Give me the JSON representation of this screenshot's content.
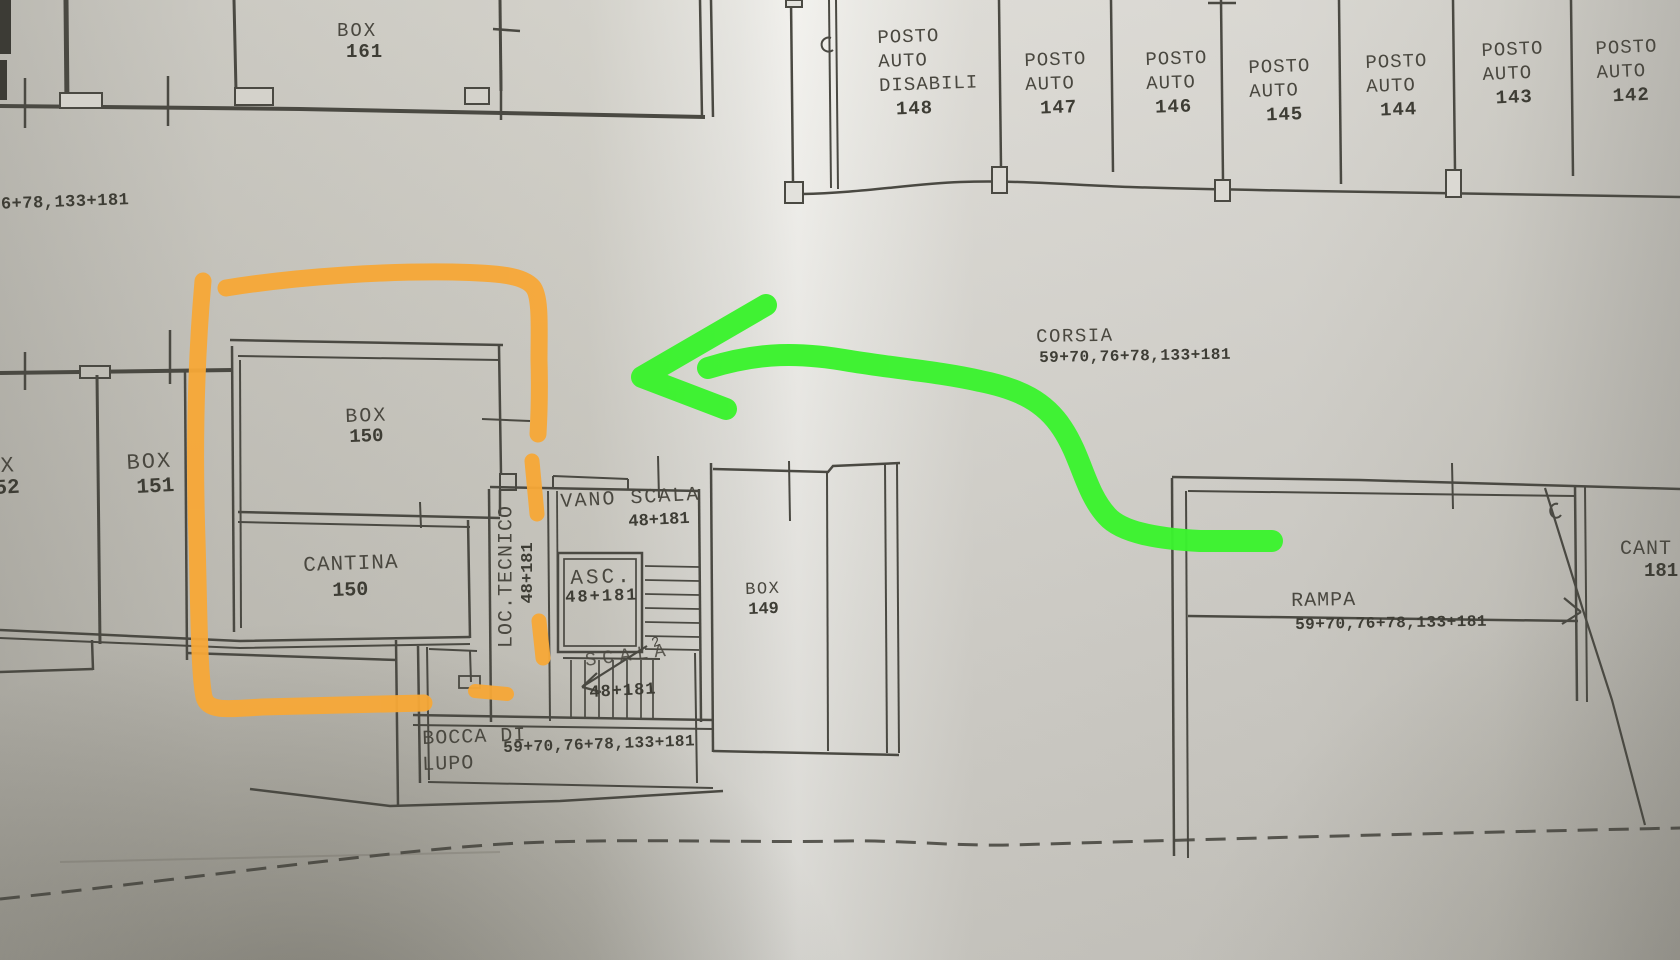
{
  "annotations": {
    "highlight_color": "#f7a837",
    "arrow_color": "#3bf32e",
    "highlight_shape": "hand-drawn rectangle around BOX 150 / CANTINA 150",
    "arrow_shape": "hand-drawn arrow pointing left from RAMPA toward highlighted rooms"
  },
  "labels": {
    "dim_left": "76+78,133+181",
    "box161": {
      "name": "BOX",
      "num": "161"
    },
    "corsia": {
      "name": "CORSIA",
      "dims": "59+70,76+78,133+181"
    },
    "box152": {
      "name": "X",
      "num": "52"
    },
    "box151": {
      "name": "BOX",
      "num": "151"
    },
    "box150": {
      "name": "BOX",
      "num": "150"
    },
    "cantina150": {
      "name": "CANTINA",
      "num": "150"
    },
    "loc_tecnico": {
      "name": "LOC.TECNICO",
      "dims": "48+181"
    },
    "vano_scala": {
      "name": "VANO SCALA",
      "dims": "48+181"
    },
    "asc": {
      "name": "ASC.",
      "dims": "48+181"
    },
    "scala": {
      "name": "SCALA",
      "dims": "48+181",
      "mark": "2"
    },
    "box149": {
      "name": "BOX",
      "num": "149"
    },
    "bocca_di_lupo": {
      "line1": "BOCCA DI",
      "line2": "LUPO",
      "dims": "59+70,76+78,133+181"
    },
    "rampa": {
      "name": "RAMPA",
      "dims": "59+70,76+78,133+181"
    },
    "cantina181": {
      "name": "CANT",
      "num": "181"
    }
  },
  "parking": [
    {
      "l1": "POSTO",
      "l2": "AUTO",
      "l3": "DISABILI",
      "num": "148"
    },
    {
      "l1": "POSTO",
      "l2": "AUTO",
      "num": "147"
    },
    {
      "l1": "POSTO",
      "l2": "AUTO",
      "num": "146"
    },
    {
      "l1": "POSTO",
      "l2": "AUTO",
      "num": "145"
    },
    {
      "l1": "POSTO",
      "l2": "AUTO",
      "num": "144"
    },
    {
      "l1": "POSTO",
      "l2": "AUTO",
      "num": "143"
    },
    {
      "l1": "POSTO",
      "l2": "AUTO",
      "num": "142"
    }
  ]
}
